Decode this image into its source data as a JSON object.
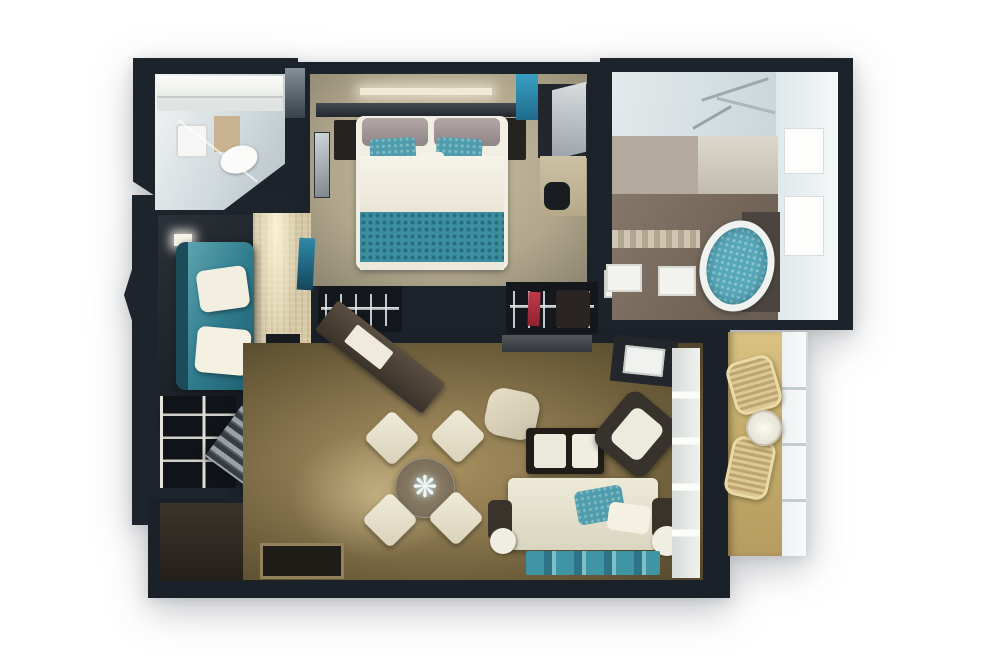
{
  "scene": {
    "type": "3d-floor-plan-rendering",
    "description": "Top-down 3D rendered floor plan of a two-bedroom suite with two bathrooms, living-dining room and balcony on a white background",
    "background_color": "#ffffff",
    "wall_color": "#1d242c"
  },
  "palette": {
    "walls": "#1d242c",
    "bedroom_carpet": "#bdb298",
    "living_carpet": "#8d7a52",
    "lounge_floor": "#d6c9a6",
    "balcony_deck": "#cdb377",
    "teal_accent": "#3f95a4",
    "teal_dark": "#2e7486",
    "fabric_white": "#efece0",
    "bath_tile": "#dde4e7",
    "bath_floor_taupe": "#77695d",
    "tub_water": "#56a7b8",
    "wood_dark": "#4d4339",
    "red_garment": "#b32f3e"
  },
  "decor": {
    "flower_glyph": "❋"
  },
  "rooms": [
    {
      "id": "guest-bathroom",
      "name": "Guest Bathroom",
      "position": "top-left",
      "furniture": [
        "vanity",
        "shelf",
        "sink",
        "toilet",
        "glass-shower"
      ]
    },
    {
      "id": "master-bedroom",
      "name": "Master Bedroom",
      "position": "top-center",
      "furniture": [
        "king-bed",
        "teal-runner",
        "teal-pillows",
        "nightstands",
        "wall-art",
        "dresser",
        "vanity-desk",
        "chair",
        "two-wardrobes"
      ]
    },
    {
      "id": "master-bathroom",
      "name": "Master Bathroom",
      "position": "top-right",
      "furniture": [
        "glass-shower",
        "vanity-counter",
        "towel-rail",
        "two-bath-mats",
        "whirlpool-tub",
        "window-band"
      ]
    },
    {
      "id": "lounge",
      "name": "Second Bedroom / Lounge",
      "position": "left",
      "furniture": [
        "teal-sofa-bed",
        "two-white-pillows",
        "tv-console",
        "wall-art",
        "shelving-unit",
        "stairs"
      ]
    },
    {
      "id": "living-dining",
      "name": "Living & Dining Room",
      "position": "center",
      "furniture": [
        "angled-sideboard",
        "tv-panel",
        "round-dining-table",
        "four-cream-chairs",
        "ottoman",
        "coffee-table",
        "cream-sofa",
        "teal-pillow",
        "armchair",
        "teal-rug",
        "balcony-door"
      ]
    },
    {
      "id": "entry",
      "name": "Entry Hall",
      "position": "bottom-left",
      "furniture": [
        "doormat"
      ]
    },
    {
      "id": "balcony",
      "name": "Balcony",
      "position": "right",
      "furniture": [
        "two-wicker-chairs",
        "round-table",
        "glass-railing"
      ]
    }
  ]
}
